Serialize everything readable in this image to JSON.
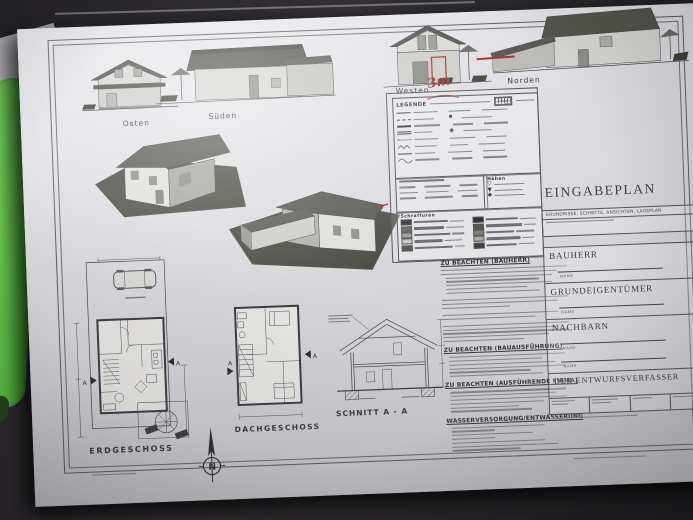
{
  "photo": {
    "table_color": "#2b292a",
    "paper_color": "#dcdbdf",
    "pen_color": "#5fbe49",
    "annotation_red": "#a2362e"
  },
  "elevations": {
    "osten": {
      "label": "Osten"
    },
    "sueden": {
      "label": "Süden"
    },
    "westen": {
      "label": "Westen",
      "annotation": "3m"
    },
    "norden": {
      "label": "Norden"
    }
  },
  "legend": {
    "title": "LEGENDE",
    "hoehen": "Höhen",
    "schraffuren": "Schraffuren"
  },
  "notes": {
    "h1": "ZU BEACHTEN (BAUHERR)",
    "h2": "ZU BEACHTEN (BAUAUSFÜHRUNG)",
    "h3": "ZU BEACHTEN (AUSFÜHRENDE FIRMA)",
    "h4": "WASSERVERSORGUNG/ENTWÄSSERUNG"
  },
  "plans": {
    "erdgeschoss": "ERDGESCHOSS",
    "dachgeschoss": "DACHGESCHOSS",
    "schnitt": "SCHNITT A - A",
    "north": "N",
    "section_marker": "A"
  },
  "title_block": {
    "title": "EINGABEPLAN",
    "subtitle": "GRUNDRISSE, SCHNITTE, ANSICHTEN, LAGEPLAN",
    "bauherr": "BAUHERR",
    "grundeigentuemer": "GRUNDEIGENTÜMER",
    "nachbarn": "NACHBARN",
    "entwurfsverfasser": "DER ENTWURFSVERFASSER",
    "name_caption": "NAME"
  }
}
